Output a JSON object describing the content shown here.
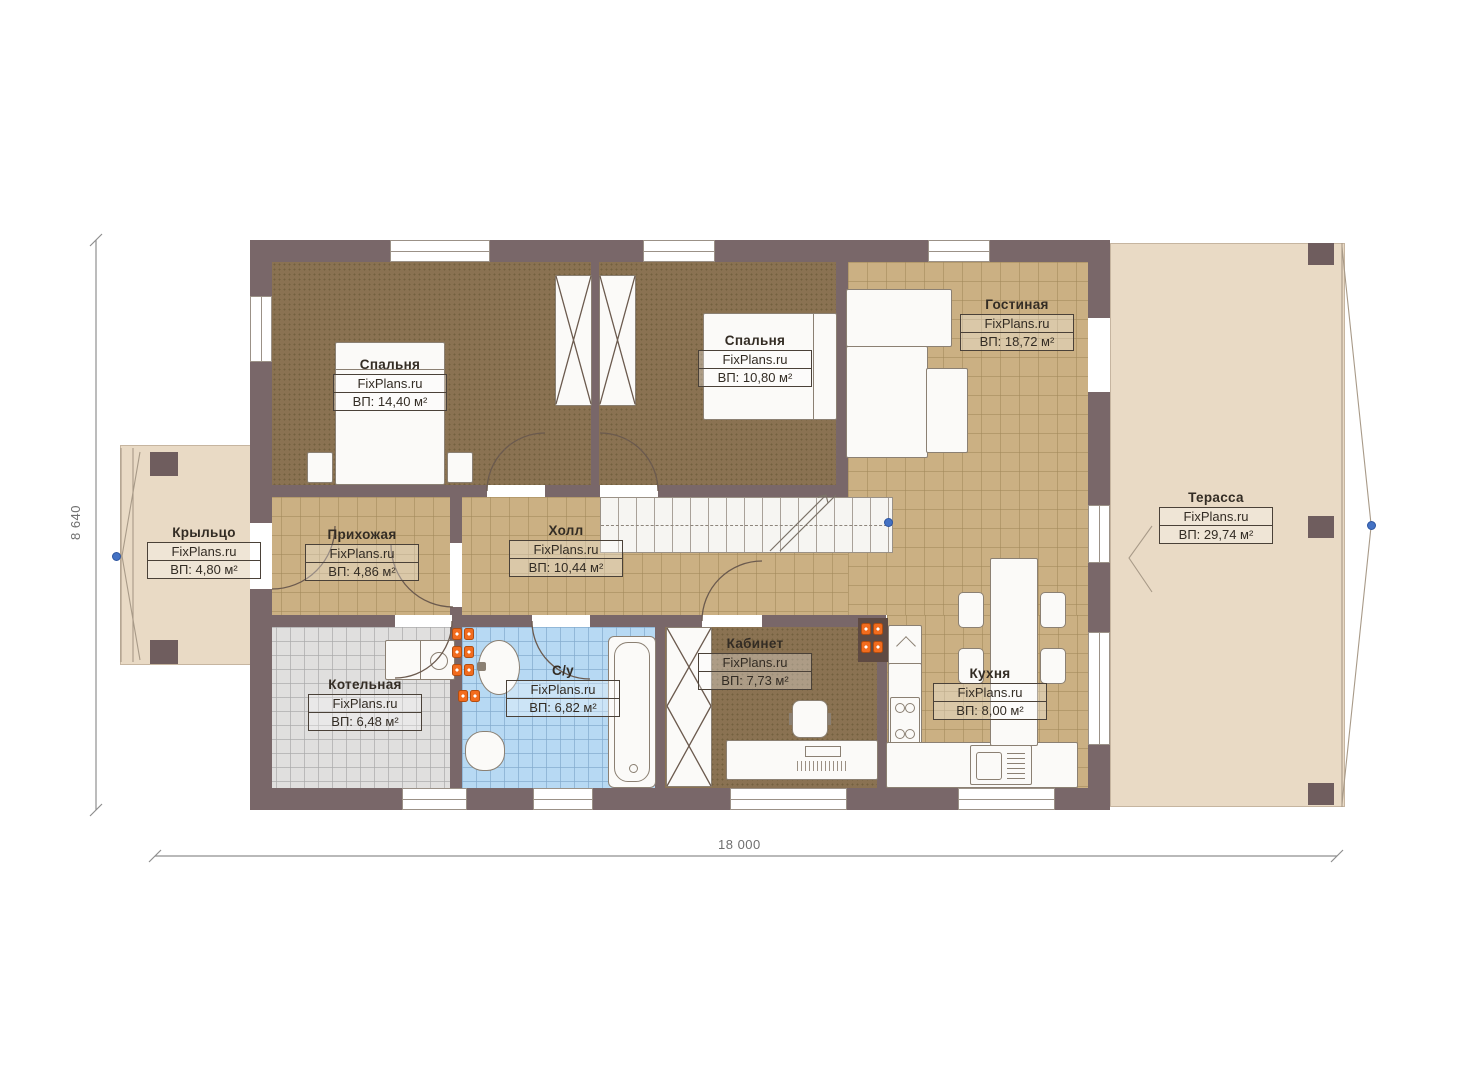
{
  "plan": {
    "title": "План 1 этажа",
    "brand": "FixPlans.ru",
    "rooms": [
      {
        "id": "bedroom-1",
        "name": "Спальня",
        "brand": "FixPlans.ru",
        "area": "ВП: 14,40 м²"
      },
      {
        "id": "bedroom-2",
        "name": "Спальня",
        "brand": "FixPlans.ru",
        "area": "ВП: 10,80 м²"
      },
      {
        "id": "living",
        "name": "Гостиная",
        "brand": "FixPlans.ru",
        "area": "ВП: 18,72 м²"
      },
      {
        "id": "terrace",
        "name": "Терасса",
        "brand": "FixPlans.ru",
        "area": "ВП: 29,74 м²"
      },
      {
        "id": "porch",
        "name": "Крыльцо",
        "brand": "FixPlans.ru",
        "area": "ВП: 4,80 м²"
      },
      {
        "id": "entry-hall",
        "name": "Прихожая",
        "brand": "FixPlans.ru",
        "area": "ВП: 4,86 м²"
      },
      {
        "id": "hall",
        "name": "Холл",
        "brand": "FixPlans.ru",
        "area": "ВП: 10,44 м²"
      },
      {
        "id": "boiler",
        "name": "Котельная",
        "brand": "FixPlans.ru",
        "area": "ВП: 6,48 м²"
      },
      {
        "id": "bathroom",
        "name": "С/у",
        "brand": "FixPlans.ru",
        "area": "ВП: 6,82 м²"
      },
      {
        "id": "office",
        "name": "Кабинет",
        "brand": "FixPlans.ru",
        "area": "ВП: 7,73 м²"
      },
      {
        "id": "kitchen",
        "name": "Кухня",
        "brand": "FixPlans.ru",
        "area": "ВП: 8,00 м²"
      }
    ],
    "dimensions": {
      "width": "18 000",
      "height": "8 640"
    },
    "colors": {
      "wall": "#796769",
      "tile_tan": "#cbb083",
      "tile_gray": "#e0dfde",
      "tile_blue": "#b7d9f3",
      "carpet_brown": "#8a7252",
      "deck_beige": "#e9dac5",
      "radiator_orange": "#f26c1e",
      "marker_blue": "#4472c4"
    }
  }
}
